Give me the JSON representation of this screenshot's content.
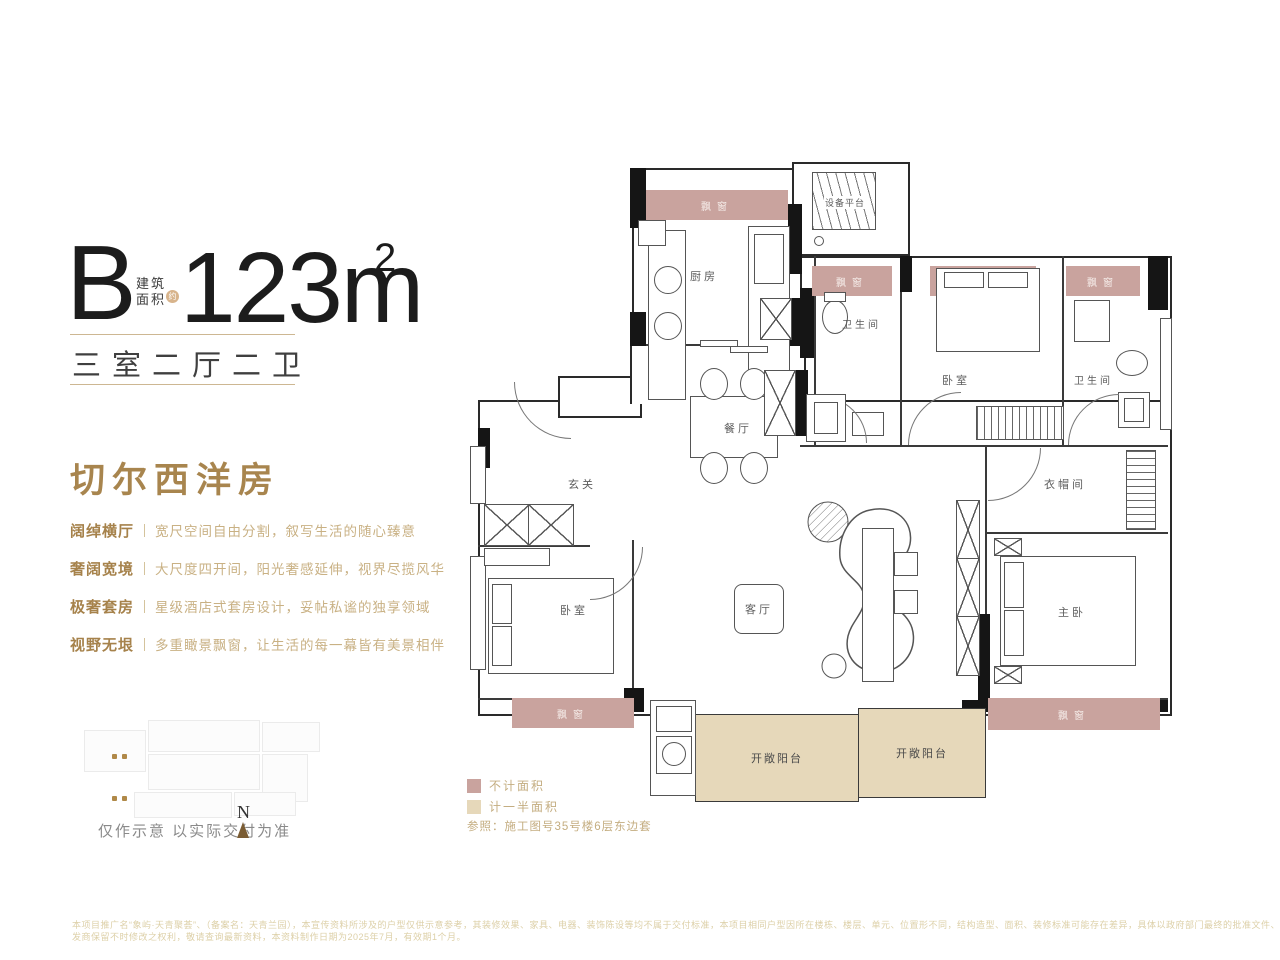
{
  "unit": {
    "type": "B",
    "area_prefix_l1": "建筑",
    "area_prefix_l2": "面积",
    "approx": "约",
    "area": "123m",
    "area_sup": "2",
    "rooms_summary": "三室二厅二卫"
  },
  "headline": "切尔西洋房",
  "features": [
    {
      "label": "阔绰横厅",
      "desc": "宽尺空间自由分割，叙写生活的随心臻意"
    },
    {
      "label": "奢阔宽境",
      "desc": "大尺度四开间，阳光奢感延伸，视界尽揽风华"
    },
    {
      "label": "极奢套房",
      "desc": "星级酒店式套房设计，妥帖私谧的独享领域"
    },
    {
      "label": "视野无垠",
      "desc": "多重瞰景飘窗，让生活的每一幕皆有美景相伴"
    }
  ],
  "siteplan": {
    "note": "仅作示意 以实际交付为准",
    "north": "N"
  },
  "legend": {
    "no_area": "不计面积",
    "half_area": "计一半面积",
    "reference": "参照：施工图号35号楼6层东边套"
  },
  "plan_labels": {
    "kitchen": "厨房",
    "equipment_platform": "设备平台",
    "bath": "卫生间",
    "dining": "餐厅",
    "foyer": "玄关",
    "bedroom": "卧室",
    "cloakroom": "衣帽间",
    "living": "客厅",
    "master": "主卧",
    "balcony": "开敞阳台",
    "bay_window": "飘窗"
  },
  "colors": {
    "accent_gold": "#a8854e",
    "light_gold": "#c9b184",
    "bay_pink": "#c9a39e",
    "balcony_tan": "#e6d8ba"
  },
  "disclaimer": {
    "line1": "本项目推广名“象屿·天青聚荟”、（备案名：天青兰园），本宣传资料所涉及的户型仅供示意参考，其装修效果、家具、电器、装饰陈设等均不属于交付标准，本项目相同户型因所在楼栋、楼层、单元、位置形不同，结构造型、面积、装修标准可能存在差异，具体以政府部门最终的批准文件、商品房买卖合同及其补充协议的相关约定及实际交付为准。开",
    "line2": "发商保留不时修改之权利，敬请查询最新资料，本资料制作日期为2025年7月，有效期1个月。"
  }
}
